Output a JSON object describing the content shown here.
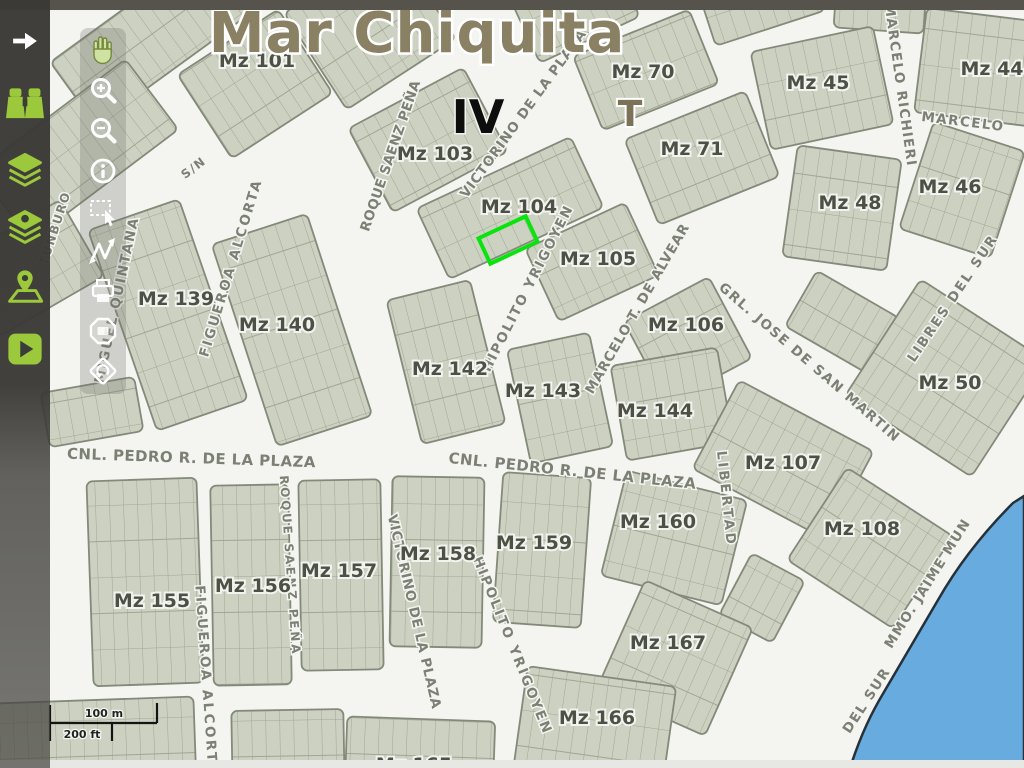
{
  "app": {
    "title": "Mar Chiquita",
    "zone_label": "IV",
    "t_label": "T"
  },
  "scalebar": {
    "metric": "100 m",
    "imperial": "200 ft"
  },
  "sidebar": {
    "icons": [
      {
        "name": "expand-arrow-icon"
      },
      {
        "name": "binoculars-icon"
      },
      {
        "name": "layers-icon"
      },
      {
        "name": "layers-alt-icon"
      },
      {
        "name": "map-location-icon"
      },
      {
        "name": "play-icon"
      }
    ]
  },
  "map_toolbar": {
    "icons": [
      {
        "name": "pan-hand-icon"
      },
      {
        "name": "zoom-in-icon"
      },
      {
        "name": "zoom-out-icon"
      },
      {
        "name": "info-icon"
      },
      {
        "name": "select-area-icon"
      },
      {
        "name": "measure-icon"
      },
      {
        "name": "print-icon"
      },
      {
        "name": "snapshot-icon"
      },
      {
        "name": "previous-view-icon"
      }
    ]
  },
  "map": {
    "selected_parcel_color": "#0ae40e",
    "water_color": "#68abdf",
    "block_fill": "#ccd1c2",
    "street_color": "#f4f4f1",
    "blocks": [
      {
        "label": "Mz 101"
      },
      {
        "label": "Mz 103"
      },
      {
        "label": "Mz 104"
      },
      {
        "label": "Mz 105"
      },
      {
        "label": "Mz 106"
      },
      {
        "label": "Mz 70"
      },
      {
        "label": "Mz 71"
      },
      {
        "label": "Mz 45"
      },
      {
        "label": "Mz 44"
      },
      {
        "label": "Mz 48"
      },
      {
        "label": "Mz 46"
      },
      {
        "label": "Mz 139"
      },
      {
        "label": "Mz 140"
      },
      {
        "label": "Mz 142"
      },
      {
        "label": "Mz 143"
      },
      {
        "label": "Mz 144"
      },
      {
        "label": "Mz 50"
      },
      {
        "label": "Mz 107"
      },
      {
        "label": "Mz 108"
      },
      {
        "label": "Mz 160"
      },
      {
        "label": "Mz 159"
      },
      {
        "label": "Mz 158"
      },
      {
        "label": "Mz 157"
      },
      {
        "label": "Mz 156"
      },
      {
        "label": "Mz 155"
      },
      {
        "label": "Mz 167"
      },
      {
        "label": "Mz 166"
      },
      {
        "label": "Mz 165"
      }
    ],
    "streets": [
      {
        "name": "S/N"
      },
      {
        "name": "MIGUEL QUINTANA"
      },
      {
        "name": "FIGUEROA ALCORTA"
      },
      {
        "name": "ROQUE SAENZ PEÑA"
      },
      {
        "name": "VICTORINO DE LA PLAZA"
      },
      {
        "name": "HIPOLITO YRIGOYEN"
      },
      {
        "name": "MARCELO T. DE ALVEAR"
      },
      {
        "name": "GRL. JOSE DE SAN MARTIN"
      },
      {
        "name": "MARCELO RICHIERI"
      },
      {
        "name": "MARCELO"
      },
      {
        "name": "LIBRES DEL SUR"
      },
      {
        "name": "CNL. PEDRO R. DE LA PLAZA"
      },
      {
        "name": "CNL. PEDRO R. DE LA PLAZA"
      },
      {
        "name": "LIBERTAD"
      },
      {
        "name": "VICTORINO DE LA PLAZA"
      },
      {
        "name": "HIPOLITO YRIGOYEN"
      },
      {
        "name": "ROQUE SAENZ PEÑA"
      },
      {
        "name": "FIGUEROA ALCORTA"
      },
      {
        "name": "DEL SUR"
      },
      {
        "name": "MMO. JAIME MUN"
      },
      {
        "name": "TUNBURO"
      }
    ]
  }
}
